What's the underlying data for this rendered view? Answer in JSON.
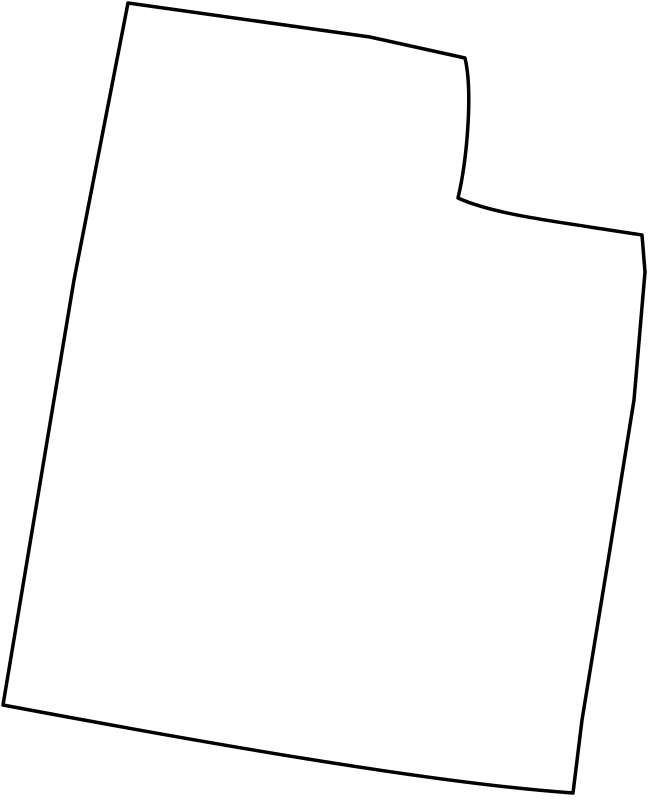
{
  "window": {
    "background_color": "#ffffff"
  },
  "map": {
    "region": "Utah state outline",
    "type": "outline-map",
    "stroke_color": "#000000",
    "fill_color": "none",
    "stroke_width": "3.5",
    "outline_path": "M 128,3 L 370,37 L 465,58 C 473,92 467,160 458,198 C 495,215 560,222 642,235 L 645,272 L 634,400 L 610,549 L 582,720 L 573,793 C 430,783 195,741 3,705 L 74,280 Z",
    "features": {
      "top_left_corner": [
        128,
        3
      ],
      "notch_top_corner": [
        465,
        58
      ],
      "notch_inner_corner": [
        458,
        198
      ],
      "notch_right_corner": [
        642,
        235
      ],
      "bottom_right_corner": [
        573,
        793
      ],
      "bottom_left_corner": [
        3,
        705
      ]
    }
  }
}
